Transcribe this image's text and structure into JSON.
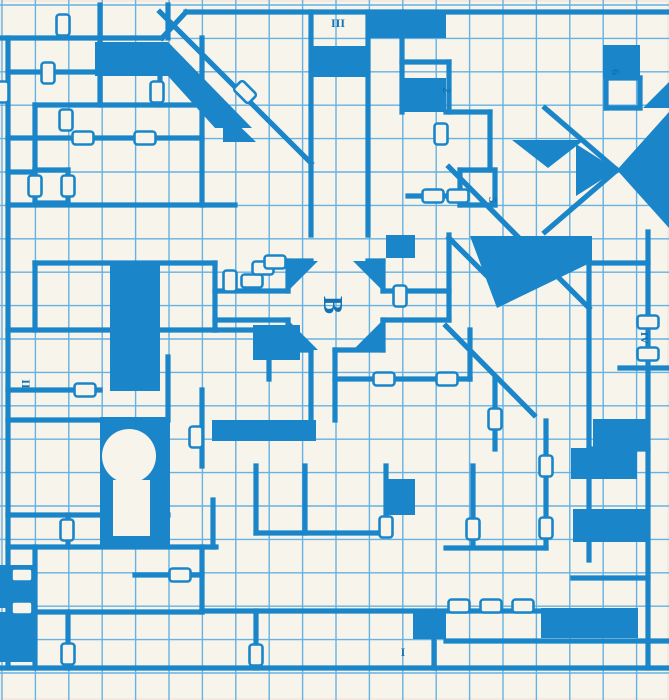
{
  "map": {
    "title": "Blue dungeon grid map, level plan with rooms, corridors, doors and area labels",
    "colors": {
      "ink": "#1a86c9",
      "grid": "#66b2e2",
      "paper": "#f7f4ec",
      "label": "#1272b4"
    },
    "grid": {
      "pitch": 33.4,
      "ox": 2,
      "oy": 5,
      "w": 669,
      "h": 700,
      "thin": 1.4,
      "thick": 5.2
    },
    "walls": [
      [
        2,
        38,
        162,
        38
      ],
      [
        186,
        12,
        669,
        12
      ],
      [
        8,
        38,
        8,
        668
      ],
      [
        2,
        668,
        669,
        668
      ],
      [
        648,
        232,
        648,
        668
      ],
      [
        100,
        5,
        100,
        38
      ],
      [
        168,
        5,
        168,
        38
      ],
      [
        311,
        12,
        311,
        235
      ],
      [
        368,
        12,
        368,
        235
      ],
      [
        402,
        12,
        402,
        112
      ],
      [
        449,
        62,
        449,
        112
      ],
      [
        402,
        62,
        449,
        62
      ],
      [
        446,
        112,
        490,
        112
      ],
      [
        490,
        112,
        490,
        170
      ],
      [
        606,
        78,
        640,
        78
      ],
      [
        606,
        78,
        606,
        108
      ],
      [
        606,
        108,
        640,
        108
      ],
      [
        640,
        78,
        640,
        108
      ],
      [
        8,
        72,
        100,
        72
      ],
      [
        35,
        105,
        202,
        105
      ],
      [
        100,
        38,
        100,
        105
      ],
      [
        35,
        105,
        35,
        172
      ],
      [
        8,
        138,
        202,
        138
      ],
      [
        160,
        72,
        160,
        105
      ],
      [
        202,
        38,
        202,
        205
      ],
      [
        8,
        172,
        35,
        172
      ],
      [
        35,
        170,
        68,
        170
      ],
      [
        35,
        170,
        35,
        203
      ],
      [
        68,
        170,
        68,
        203
      ],
      [
        35,
        203,
        68,
        203
      ],
      [
        8,
        205,
        235,
        205
      ],
      [
        35,
        263,
        215,
        263
      ],
      [
        215,
        263,
        215,
        330
      ],
      [
        215,
        330,
        269,
        330
      ],
      [
        35,
        263,
        35,
        330
      ],
      [
        8,
        330,
        215,
        330
      ],
      [
        8,
        390,
        100,
        390
      ],
      [
        168,
        357,
        168,
        420
      ],
      [
        202,
        390,
        202,
        466
      ],
      [
        8,
        420,
        100,
        420
      ],
      [
        288,
        261,
        311,
        261
      ],
      [
        368,
        261,
        383,
        261
      ],
      [
        288,
        261,
        288,
        291
      ],
      [
        288,
        320,
        288,
        350
      ],
      [
        383,
        261,
        383,
        291
      ],
      [
        383,
        320,
        383,
        350
      ],
      [
        288,
        350,
        311,
        350
      ],
      [
        335,
        350,
        383,
        350
      ],
      [
        311,
        350,
        311,
        420
      ],
      [
        335,
        350,
        335,
        420
      ],
      [
        215,
        291,
        288,
        291
      ],
      [
        215,
        320,
        288,
        320
      ],
      [
        383,
        291,
        449,
        291
      ],
      [
        383,
        320,
        449,
        320
      ],
      [
        449,
        235,
        449,
        320
      ],
      [
        335,
        379,
        470,
        379
      ],
      [
        470,
        330,
        470,
        379
      ],
      [
        495,
        379,
        495,
        449
      ],
      [
        460,
        170,
        495,
        170
      ],
      [
        460,
        170,
        460,
        205
      ],
      [
        495,
        170,
        495,
        205
      ],
      [
        460,
        205,
        495,
        205
      ],
      [
        408,
        196,
        460,
        196
      ],
      [
        589,
        263,
        589,
        560
      ],
      [
        589,
        263,
        648,
        263
      ],
      [
        620,
        368,
        669,
        368
      ],
      [
        589,
        449,
        648,
        449
      ],
      [
        8,
        515,
        168,
        515
      ],
      [
        213,
        500,
        213,
        547
      ],
      [
        8,
        547,
        216,
        547
      ],
      [
        68,
        515,
        68,
        547
      ],
      [
        35,
        547,
        35,
        668
      ],
      [
        8,
        575,
        35,
        575
      ],
      [
        8,
        608,
        35,
        608
      ],
      [
        35,
        612,
        202,
        612
      ],
      [
        68,
        612,
        68,
        668
      ],
      [
        135,
        575,
        202,
        575
      ],
      [
        202,
        547,
        202,
        612
      ],
      [
        256,
        466,
        256,
        533
      ],
      [
        256,
        533,
        386,
        533
      ],
      [
        305,
        466,
        305,
        533
      ],
      [
        386,
        466,
        386,
        533
      ],
      [
        202,
        611,
        545,
        611
      ],
      [
        256,
        611,
        256,
        668
      ],
      [
        434,
        611,
        434,
        668
      ],
      [
        473,
        466,
        473,
        547
      ],
      [
        446,
        548,
        546,
        548
      ],
      [
        546,
        421,
        546,
        548
      ],
      [
        573,
        578,
        648,
        578
      ],
      [
        446,
        641,
        669,
        641
      ],
      [
        269,
        330,
        269,
        379
      ]
    ],
    "diagonal_walls": [
      [
        162,
        38,
        186,
        12
      ],
      [
        160,
        12,
        311,
        163
      ],
      [
        449,
        167,
        533,
        252
      ],
      [
        449,
        238,
        504,
        293
      ],
      [
        545,
        108,
        617,
        170
      ],
      [
        545,
        232,
        617,
        170
      ],
      [
        446,
        326,
        534,
        415
      ],
      [
        533,
        252,
        589,
        308
      ]
    ],
    "fills": [
      {
        "type": "polygon",
        "points": [
          [
            95,
            42
          ],
          [
            168,
            42
          ],
          [
            252,
            128
          ],
          [
            215,
            128
          ],
          [
            168,
            76
          ],
          [
            95,
            76
          ]
        ]
      },
      {
        "type": "polygon",
        "points": [
          [
            223,
            110
          ],
          [
            256,
            142
          ],
          [
            223,
            142
          ]
        ]
      },
      {
        "type": "rect",
        "x": 313,
        "y": 46,
        "w": 53,
        "h": 31
      },
      {
        "type": "rect",
        "x": 603,
        "y": 45,
        "w": 37,
        "h": 33
      },
      {
        "type": "polygon",
        "points": [
          [
            643,
            108
          ],
          [
            669,
            82
          ],
          [
            669,
            108
          ]
        ]
      },
      {
        "type": "polygon",
        "points": [
          [
            669,
            112
          ],
          [
            669,
            228
          ],
          [
            617,
            170
          ]
        ]
      },
      {
        "type": "polygon",
        "points": [
          [
            576,
            144
          ],
          [
            617,
            170
          ],
          [
            576,
            196
          ]
        ]
      },
      {
        "type": "polygon",
        "points": [
          [
            512,
            140
          ],
          [
            584,
            140
          ],
          [
            548,
            168
          ]
        ]
      },
      {
        "type": "polygon",
        "points": [
          [
            470,
            236
          ],
          [
            592,
            236
          ],
          [
            592,
            262
          ],
          [
            497,
            308
          ]
        ]
      },
      {
        "type": "polygon",
        "points": [
          [
            288,
            261
          ],
          [
            318,
            261
          ],
          [
            288,
            291
          ]
        ]
      },
      {
        "type": "polygon",
        "points": [
          [
            353,
            261
          ],
          [
            383,
            261
          ],
          [
            383,
            291
          ]
        ]
      },
      {
        "type": "polygon",
        "points": [
          [
            288,
            320
          ],
          [
            288,
            350
          ],
          [
            318,
            350
          ]
        ]
      },
      {
        "type": "polygon",
        "points": [
          [
            383,
            320
          ],
          [
            383,
            350
          ],
          [
            353,
            350
          ]
        ]
      },
      {
        "type": "rect",
        "x": 110,
        "y": 261,
        "w": 50,
        "h": 130
      },
      {
        "type": "rect",
        "x": 100,
        "y": 417,
        "w": 70,
        "h": 131
      },
      {
        "type": "rect",
        "x": 253,
        "y": 325,
        "w": 47,
        "h": 35
      },
      {
        "type": "rect",
        "x": 212,
        "y": 420,
        "w": 104,
        "h": 21
      },
      {
        "type": "rect",
        "x": 384,
        "y": 479,
        "w": 31,
        "h": 36
      },
      {
        "type": "rect",
        "x": 413,
        "y": 609,
        "w": 33,
        "h": 30
      },
      {
        "type": "rect",
        "x": 541,
        "y": 608,
        "w": 97,
        "h": 30
      },
      {
        "type": "rect",
        "x": 573,
        "y": 509,
        "w": 75,
        "h": 33
      },
      {
        "type": "rect",
        "x": 571,
        "y": 448,
        "w": 66,
        "h": 31
      },
      {
        "type": "rect",
        "x": 593,
        "y": 419,
        "w": 55,
        "h": 30
      },
      {
        "type": "rect",
        "x": 370,
        "y": 12,
        "w": 76,
        "h": 26
      },
      {
        "type": "rect",
        "x": 404,
        "y": 78,
        "w": 42,
        "h": 34
      },
      {
        "type": "rect",
        "x": 386,
        "y": 235,
        "w": 29,
        "h": 23
      },
      {
        "type": "rect",
        "x": 0,
        "y": 565,
        "w": 35,
        "h": 43
      },
      {
        "type": "rect",
        "x": 0,
        "y": 612,
        "w": 35,
        "h": 50
      }
    ],
    "white_overlays": [
      {
        "type": "circle",
        "cx": 129,
        "cy": 456,
        "r": 27
      },
      {
        "type": "rect",
        "x": 113,
        "y": 480,
        "w": 37,
        "h": 56
      }
    ],
    "doors": [
      {
        "x": 63,
        "y": 25,
        "o": "v"
      },
      {
        "x": 48,
        "y": 73,
        "o": "v"
      },
      {
        "x": 2,
        "y": 92,
        "o": "v"
      },
      {
        "x": 157,
        "y": 92,
        "o": "v"
      },
      {
        "x": 66,
        "y": 120,
        "o": "v"
      },
      {
        "x": 83,
        "y": 138,
        "o": "h"
      },
      {
        "x": 145,
        "y": 138,
        "o": "h"
      },
      {
        "x": 35,
        "y": 186,
        "o": "v"
      },
      {
        "x": 68,
        "y": 186,
        "o": "v"
      },
      {
        "x": 245,
        "y": 92,
        "o": "d"
      },
      {
        "x": 230,
        "y": 281,
        "o": "v"
      },
      {
        "x": 252,
        "y": 281,
        "o": "h"
      },
      {
        "x": 263,
        "y": 268,
        "o": "h"
      },
      {
        "x": 275,
        "y": 262,
        "o": "h"
      },
      {
        "x": 400,
        "y": 296,
        "o": "v"
      },
      {
        "x": 433,
        "y": 196,
        "o": "h"
      },
      {
        "x": 458,
        "y": 196,
        "o": "h"
      },
      {
        "x": 441,
        "y": 134,
        "o": "v"
      },
      {
        "x": 648,
        "y": 322,
        "o": "h"
      },
      {
        "x": 648,
        "y": 354,
        "o": "h"
      },
      {
        "x": 384,
        "y": 379,
        "o": "h"
      },
      {
        "x": 447,
        "y": 379,
        "o": "h"
      },
      {
        "x": 495,
        "y": 419,
        "o": "v"
      },
      {
        "x": 546,
        "y": 466,
        "o": "v"
      },
      {
        "x": 546,
        "y": 528,
        "o": "v"
      },
      {
        "x": 386,
        "y": 527,
        "o": "v"
      },
      {
        "x": 473,
        "y": 529,
        "o": "v"
      },
      {
        "x": 67,
        "y": 530,
        "o": "v"
      },
      {
        "x": 22,
        "y": 575,
        "o": "h"
      },
      {
        "x": 180,
        "y": 575,
        "o": "h"
      },
      {
        "x": 22,
        "y": 608,
        "o": "h"
      },
      {
        "x": 459,
        "y": 606,
        "o": "h"
      },
      {
        "x": 491,
        "y": 606,
        "o": "h"
      },
      {
        "x": 523,
        "y": 606,
        "o": "h"
      },
      {
        "x": 256,
        "y": 655,
        "o": "v"
      },
      {
        "x": 68,
        "y": 654,
        "o": "v"
      },
      {
        "x": 196,
        "y": 437,
        "o": "v"
      },
      {
        "x": 85,
        "y": 390,
        "o": "h"
      }
    ],
    "labels": [
      {
        "text": "III",
        "x": 338,
        "y": 27,
        "rot": 0,
        "size": 12
      },
      {
        "text": "2",
        "x": 443,
        "y": 90,
        "rot": 90,
        "size": 12
      },
      {
        "text": "6",
        "x": 612,
        "y": 72,
        "rot": 90,
        "size": 12
      },
      {
        "text": "5",
        "x": 489,
        "y": 200,
        "rot": 90,
        "size": 12
      },
      {
        "text": "B",
        "x": 324,
        "y": 305,
        "rot": 90,
        "size": 27
      },
      {
        "text": "II",
        "x": 22,
        "y": 384,
        "rot": 90,
        "size": 12
      },
      {
        "text": "IV",
        "x": 641,
        "y": 338,
        "rot": 90,
        "size": 11
      },
      {
        "text": "I",
        "x": 403,
        "y": 656,
        "rot": 0,
        "size": 12
      }
    ]
  }
}
